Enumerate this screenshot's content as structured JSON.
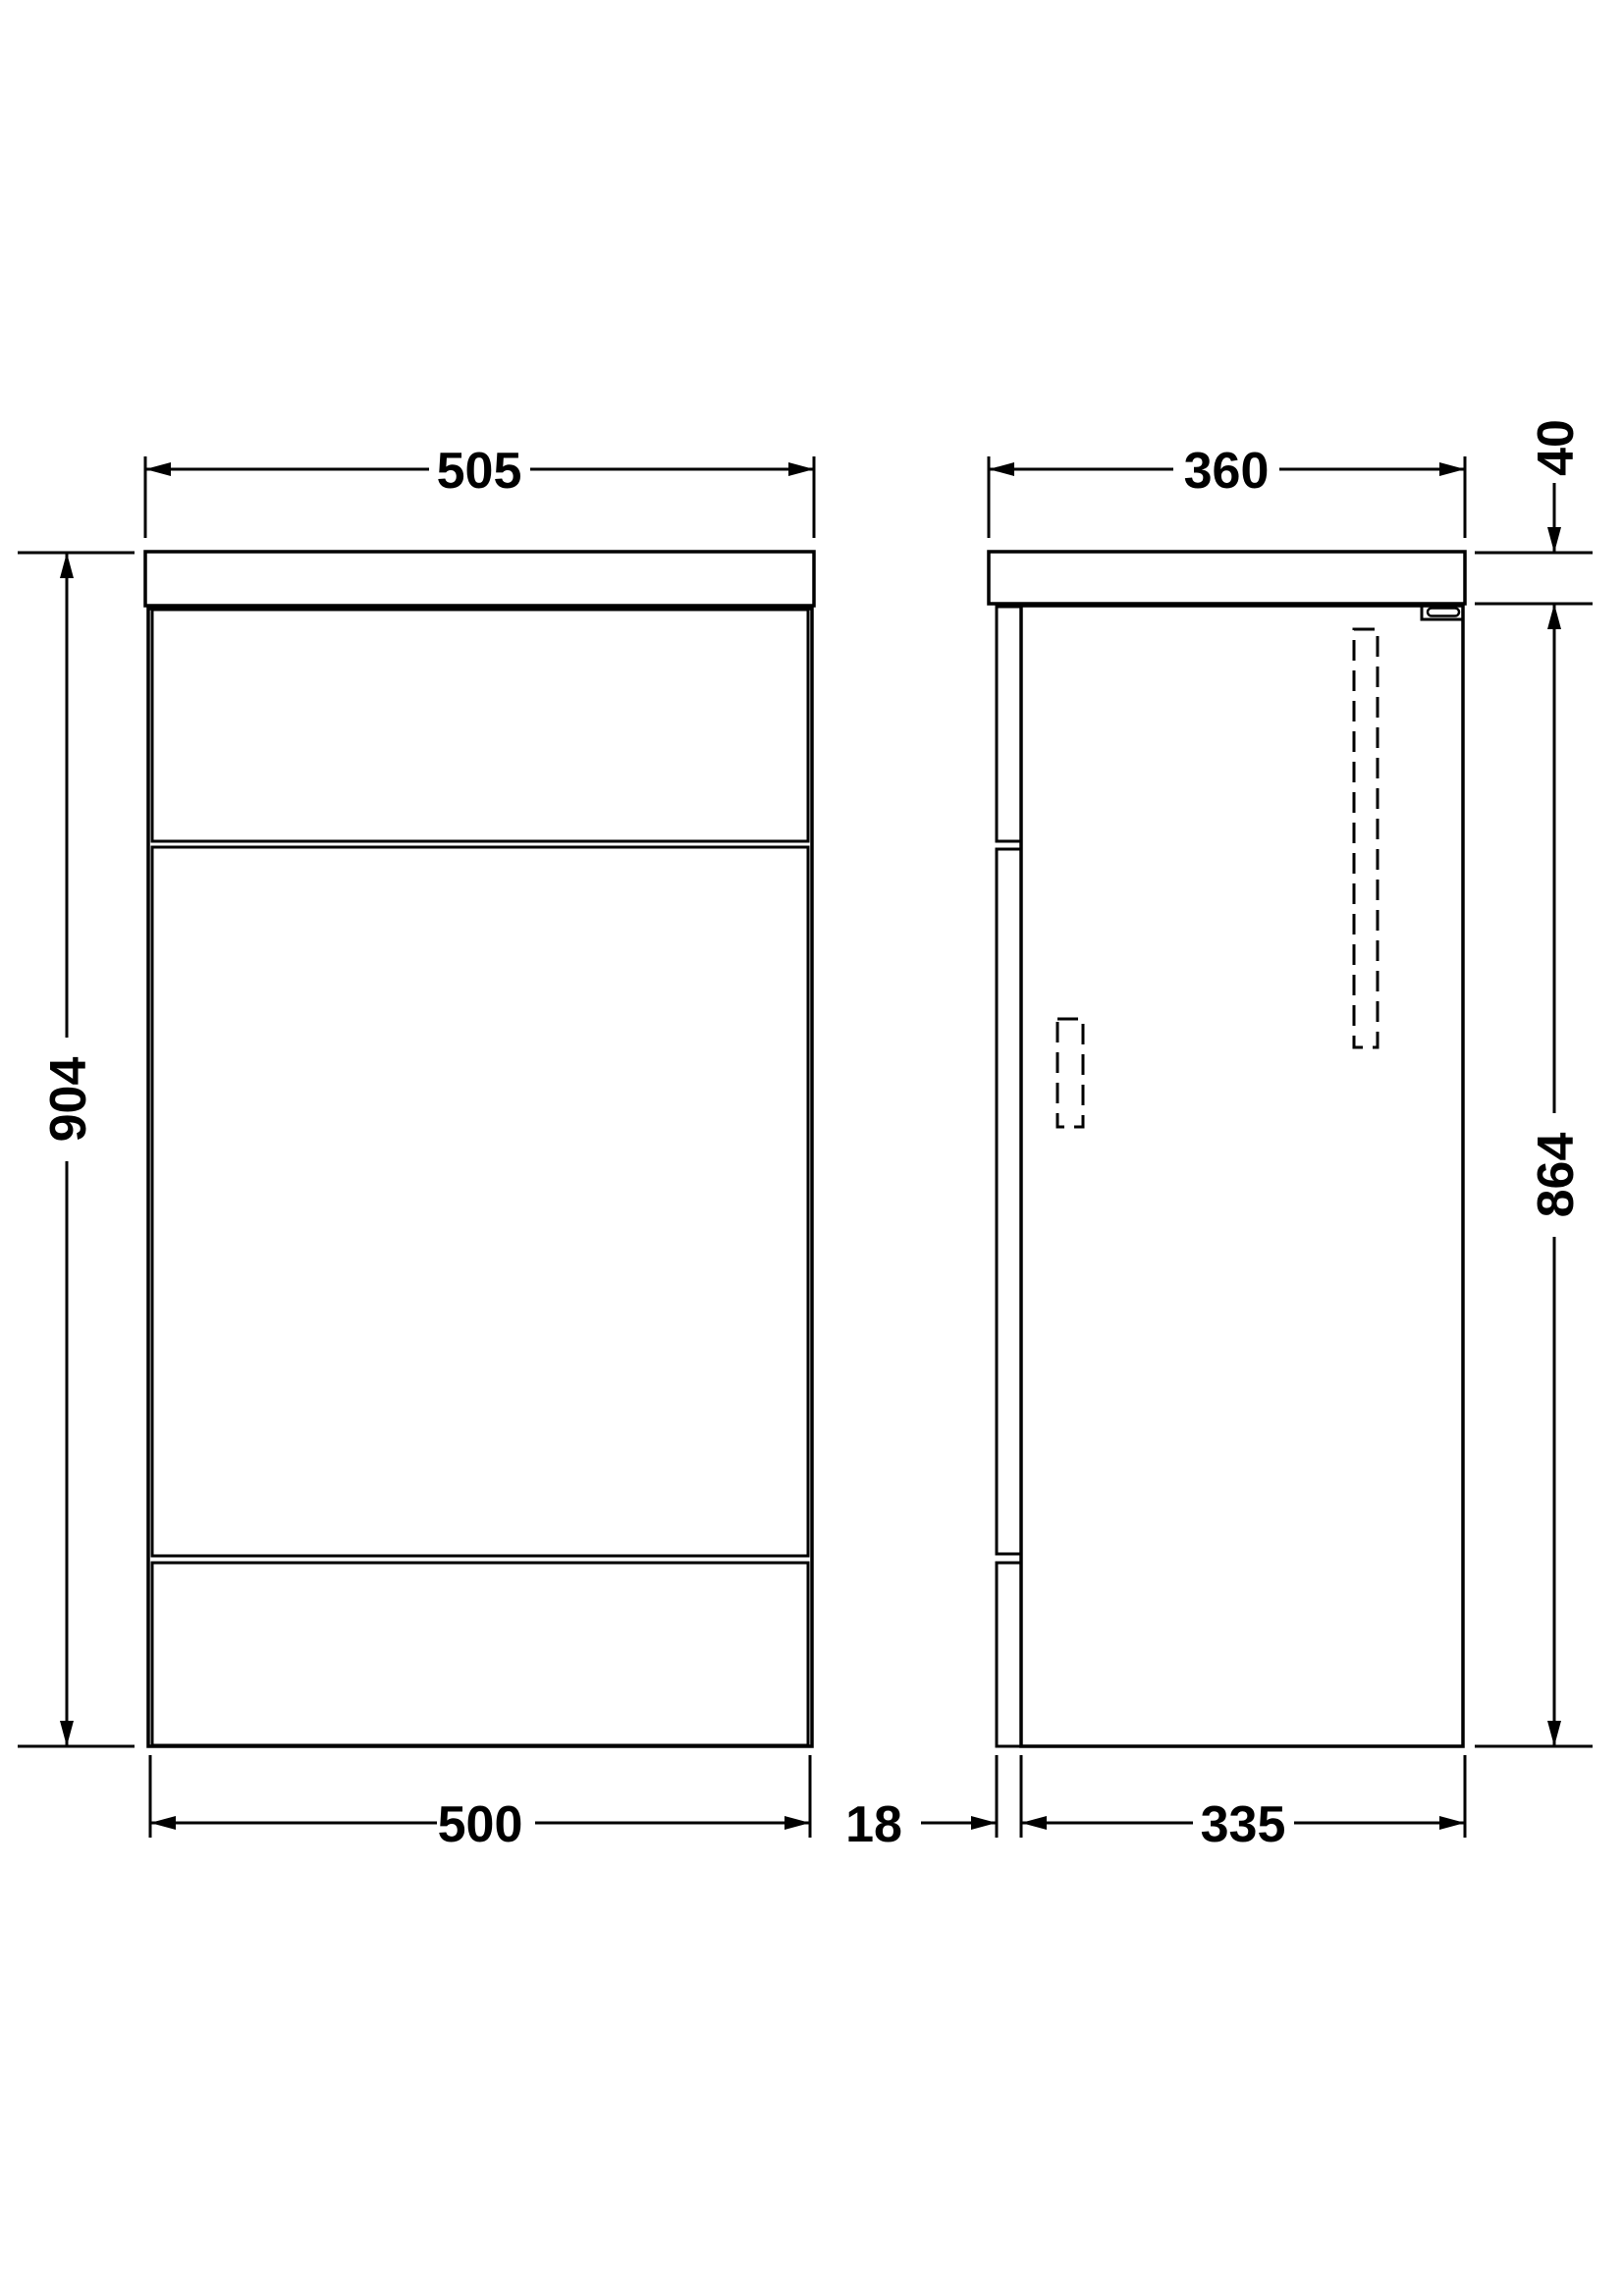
{
  "page": {
    "background": "#ffffff",
    "line_color": "#000000",
    "description": "Technical dimension drawing of a bathroom WC furniture unit, front elevation and side elevation"
  },
  "diagram": {
    "front_view": {
      "worktop_width": "505",
      "overall_height": "904",
      "cabinet_width": "500"
    },
    "side_view": {
      "worktop_depth": "360",
      "worktop_thickness": "40",
      "cabinet_height": "864",
      "back_panel_thickness": "18",
      "cabinet_depth": "335"
    }
  }
}
